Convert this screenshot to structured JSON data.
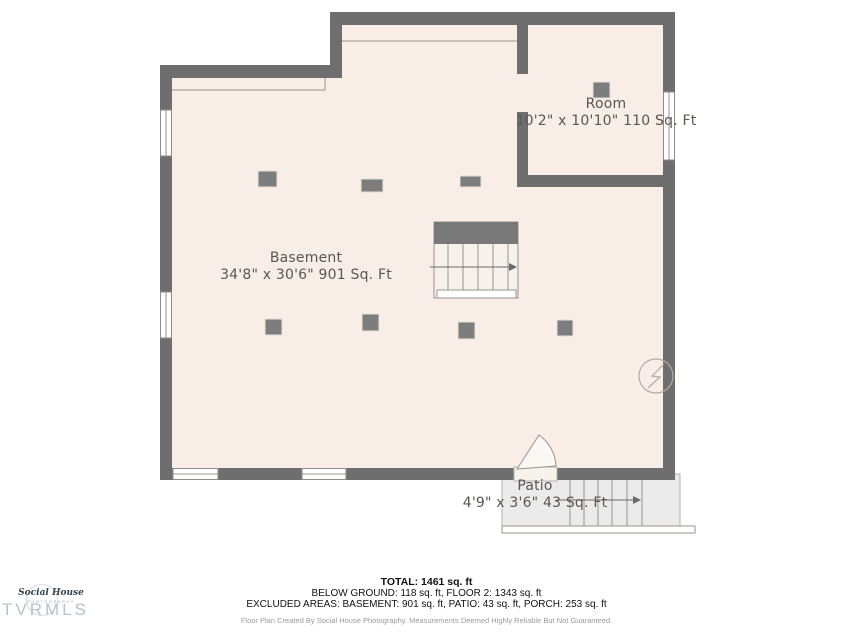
{
  "rooms": {
    "room": {
      "name": "Room",
      "dims": "10'2\" x 10'10\" 110 Sq. Ft"
    },
    "basement": {
      "name": "Basement",
      "dims": "34'8\" x 30'6\" 901 Sq. Ft"
    },
    "patio": {
      "name": "Patio",
      "dims": "4'9\" x 3'6\" 43 Sq. Ft"
    }
  },
  "summary": {
    "total": "TOTAL: 1461 sq. ft",
    "below_ground": "BELOW GROUND: 118 sq. ft, FLOOR 2: 1343 sq. ft",
    "excluded": "EXCLUDED AREAS: BASEMENT: 901 sq. ft, PATIO: 43 sq. ft, PORCH: 253 sq. ft",
    "disclaimer": "Floor Plan Created By Social House Photography. Measurements Deemed Highly Reliable But Not Guaranteed."
  },
  "branding": {
    "logo_name": "Social House",
    "logo_subtitle": "PHOTOGRAPHY",
    "watermark": "TVRMLS"
  },
  "icons": {
    "electrical_panel": "circle-lightning-bolt",
    "stairs_direction": "right-arrow",
    "patio_stairs_direction": "right-arrow",
    "door": "door-swing-arc"
  },
  "colors": {
    "wall": "#6e6e6e",
    "floor": "#f8ede7",
    "patio": "#ebebeb",
    "post": "#7d7d7d",
    "label-text": "#5b564f",
    "summary-text": "#111111",
    "disclaimer-text": "#9a9a9a",
    "watermark": "#b7c2ca",
    "logo-text": "#33424e",
    "line": "#9a938c"
  }
}
